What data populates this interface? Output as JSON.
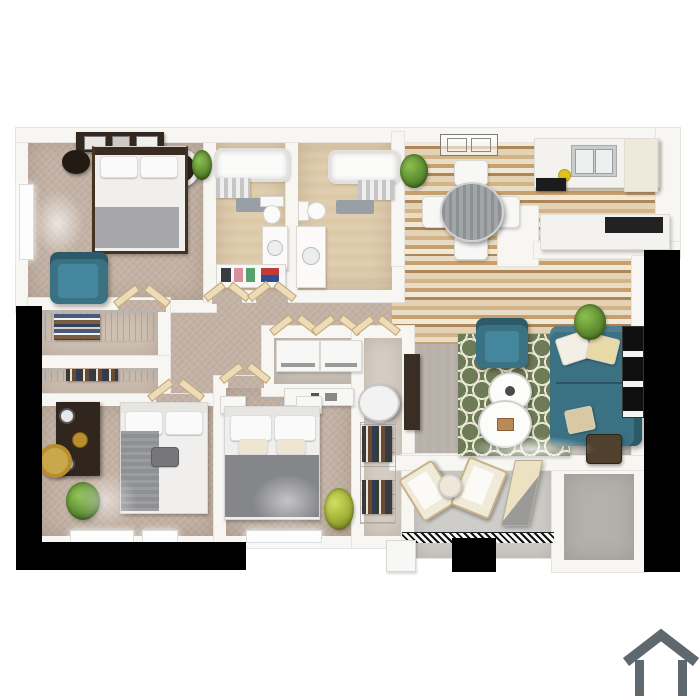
{
  "scene": {
    "description": "3D top-down architectural floor plan render of a multi-bedroom apartment on a white background",
    "background": "#ffffff",
    "no_visible_text": true
  },
  "colors": {
    "wall": "#f7f6f3",
    "wallEdge": "#e6e4e0",
    "black": "#000000",
    "carpet": "#c3b2a5",
    "carpetLight": "#cfc1b4",
    "bath": "#dcc9a8",
    "woodA": "#e9dcc4",
    "woodB": "#c89f6e",
    "woodC": "#f1e8d6",
    "woodD": "#ad875a",
    "living": "#b7b1a9",
    "patio": "#cecdc9",
    "storage": "#b4b1ad",
    "teal": "#3a7183",
    "tealDark": "#2c5a69",
    "tealLight": "#478aa0",
    "rugGreen": "#6d7b57",
    "rugCream": "#e9e6d4",
    "darkWood": "#33281f",
    "gray": "#8f9092",
    "gold": "#b98c2e",
    "plant": "#58862e",
    "plantYellow": "#9fae35",
    "icon": "#5d696f",
    "towelDark": "#3a3a44",
    "towelPink": "#d98f9c",
    "towelGreen": "#58a06c",
    "towelRed": "#c23b3b",
    "towelBlue": "#2e4f8f",
    "yellow": "#e2c11c"
  },
  "rooms": [
    {
      "name": "master-bedroom"
    },
    {
      "name": "bathroom-1"
    },
    {
      "name": "bathroom-2"
    },
    {
      "name": "walk-in-closet"
    },
    {
      "name": "second-closet"
    },
    {
      "name": "bedroom-2"
    },
    {
      "name": "bedroom-3"
    },
    {
      "name": "hallway"
    },
    {
      "name": "laundry-closet"
    },
    {
      "name": "utility-closet"
    },
    {
      "name": "dining-area"
    },
    {
      "name": "kitchen"
    },
    {
      "name": "living-room"
    },
    {
      "name": "balcony-patio"
    },
    {
      "name": "storage-room"
    }
  ],
  "furniture": [
    "king-bed",
    "queen-bed-2",
    "queen-bed-3",
    "teal-armchair-master",
    "teal-armchair-living",
    "teal-sofa",
    "trellis-rug",
    "round-coffee-tables",
    "dining-table-with-4-chairs",
    "kitchen-counter-with-sink",
    "cooktop",
    "breakfast-bar",
    "washer",
    "dryer",
    "water-heater",
    "bathtub-x2",
    "toilet-x2",
    "vanity-x2",
    "towel-shelf",
    "dresser-bedroom-2",
    "gold-mirror",
    "tv-stand",
    "patio-lounge-chairs",
    "patio-side-table",
    "potted-plants",
    "leaning-picture-frames"
  ],
  "logo": {
    "name": "house-outline-icon",
    "color": "#5d696f"
  }
}
